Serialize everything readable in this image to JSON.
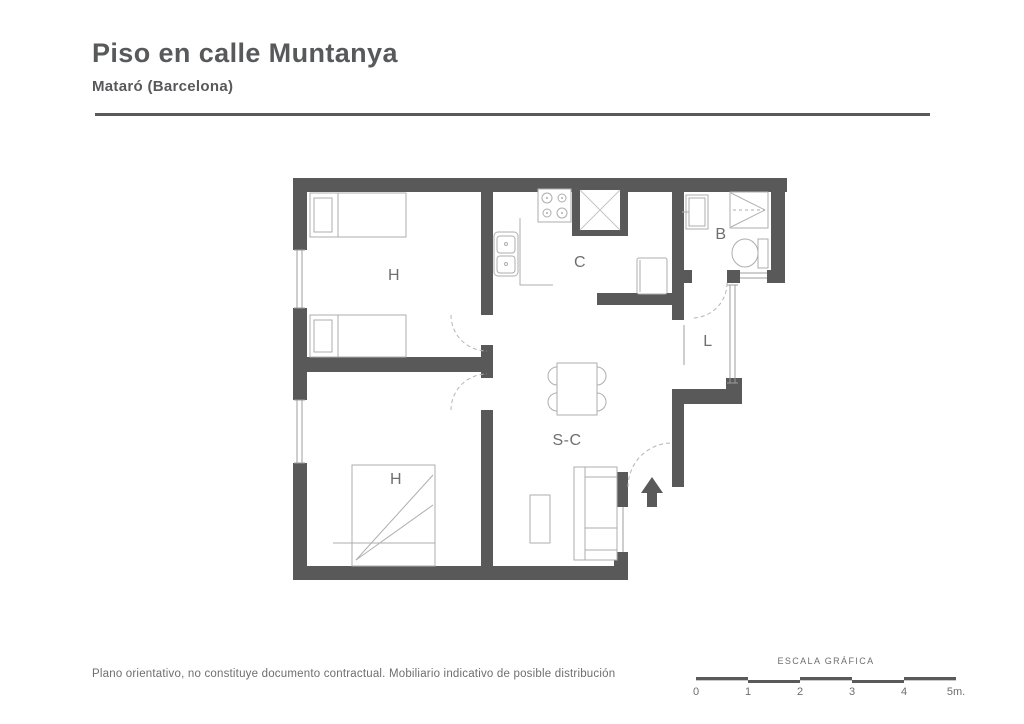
{
  "header": {
    "title": "Piso en calle Muntanya",
    "subtitle": "Mataró (Barcelona)"
  },
  "plan": {
    "rooms": {
      "bedroom1": "H",
      "bedroom2": "H",
      "kitchen": "C",
      "bathroom": "B",
      "laundry": "L",
      "living_dining": "S-C"
    }
  },
  "footer": {
    "disclaimer": "Plano orientativo, no constituye documento contractual. Mobiliario indicativo de posible distribución"
  },
  "scale_bar": {
    "title": "ESCALA GRÁFICA",
    "ticks": [
      "0",
      "1",
      "2",
      "3",
      "4",
      "5m."
    ]
  },
  "colors": {
    "wall": "#595959",
    "furniture_outline": "#aeaeae",
    "room_label": "#6f6f6f",
    "heading": "#58595b"
  }
}
